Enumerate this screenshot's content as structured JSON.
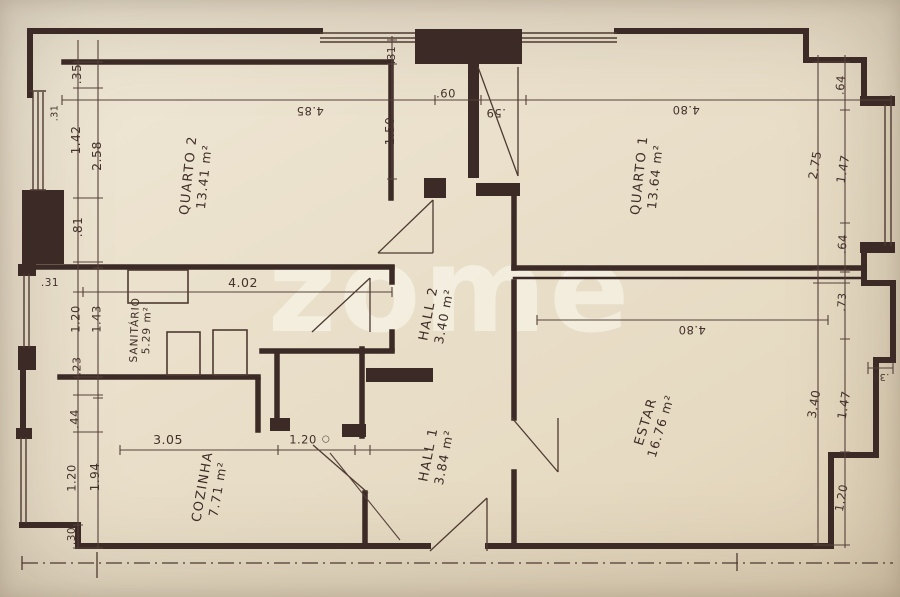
{
  "watermark": {
    "text": "zome",
    "registered": "®"
  },
  "rooms": [
    {
      "name": "QUARTO 2",
      "area": "13.41 m²"
    },
    {
      "name": "QUARTO 1",
      "area": "13.64 m²"
    },
    {
      "name": "SANITÁRIO",
      "area": "5.29 m²"
    },
    {
      "name": "HALL 2",
      "area": "3.40 m²"
    },
    {
      "name": "HALL 1",
      "area": "3.84 m²"
    },
    {
      "name": "COZINHA",
      "area": "7.71 m²"
    },
    {
      "name": "ESTAR",
      "area": "16.76 m²"
    }
  ],
  "dims": {
    "top_chain": [
      "4.85",
      ".60",
      ".59",
      "4.80"
    ],
    "mid_chain": [
      ".31",
      "1.50"
    ],
    "left_outer": [
      ".35",
      ".31",
      "1.42",
      "2.58",
      ".81"
    ],
    "left_mid": [
      ".31",
      "1.20",
      "1.43",
      ".23",
      "4.02"
    ],
    "left_lower": [
      ".44",
      "1.94",
      "1.20",
      ".30",
      "3.05",
      "1.20"
    ],
    "right_upper": [
      ".64",
      "2.75",
      "1.47",
      ".64"
    ],
    "right_lower": [
      ".73",
      "3.40",
      "1.47",
      ".30",
      "1.20"
    ],
    "estar_chain": [
      "4.80"
    ]
  },
  "marks": {
    "circle": "○"
  },
  "colors": {
    "paper": "#eae0cb",
    "ink": "#3b2a25",
    "dim_ink": "#4e3a31",
    "watermark": "rgba(252,249,241,0.55)"
  }
}
